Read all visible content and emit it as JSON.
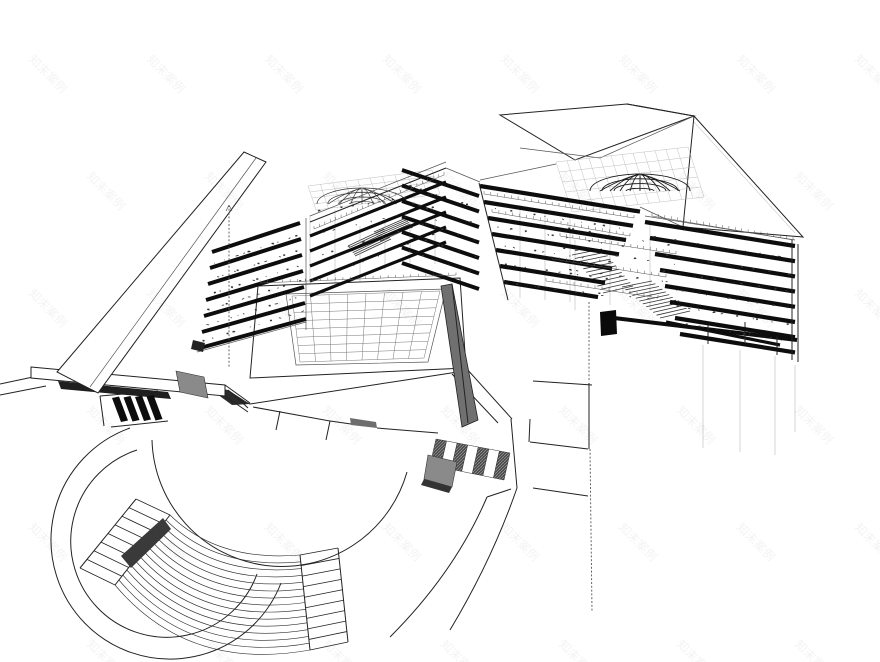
{
  "page": {
    "title": "architectural sectional perspective drawing",
    "background": "#ffffff",
    "width": 880,
    "height": 662
  },
  "watermark": {
    "text": "知末案例",
    "color": "rgba(0,0,0,0.05)",
    "font_size_px": 12,
    "rotation_deg": 45,
    "tile_spacing_x": 118,
    "tile_spacing_y": 117,
    "offset_x": 28,
    "offset_y": 60,
    "columns": 8,
    "rows": 6
  },
  "colors": {
    "background": "#ffffff",
    "ink": "#222222",
    "slab": "#0d0d0d",
    "medium_line": "#555555",
    "faint_line": "#aaaaaa",
    "shadow_dark": "#1f1f1f",
    "wall_gray": "#707070",
    "ramp_gray": "#8a8a8a",
    "wedge_dark": "#3a3a3a",
    "core_black": "#0a0a0a",
    "hatch_dark": "#4a4a4a",
    "hatch_light": "#9a9a9a"
  },
  "structure": {
    "left_building": {
      "front_face_slabs": 7,
      "upper_face_slabs": 5,
      "east_face_slabs": 7,
      "dome": "steel-gridshell",
      "courtyard_grid_cells": [
        8,
        8
      ]
    },
    "right_building": {
      "west_face_slabs": 7,
      "east_face_slabs": 8,
      "bottom_slabs": 2,
      "dome": "steel-gridshell"
    },
    "site": {
      "amphitheater_arc_steps": 15,
      "left_stair_rungs": 9,
      "right_stair_rungs": 10,
      "crosswalk_black_stripes": 4,
      "crosswalk_hatched_stripes": 7
    }
  }
}
